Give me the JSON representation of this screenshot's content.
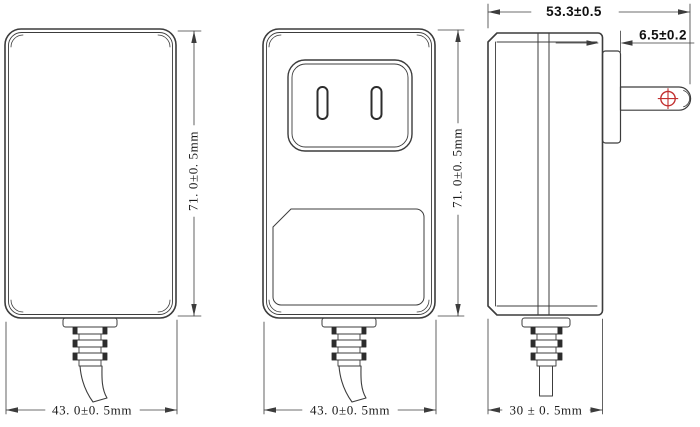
{
  "drawing": {
    "background": "#ffffff",
    "line_color": "#3c3c3c",
    "accent_red": "#c23030",
    "views": {
      "front": {
        "height_dim": "71. 0±0. 5mm",
        "width_dim": "43. 0±0. 5mm"
      },
      "back": {
        "height_dim": "71. 0±0. 5mm",
        "width_dim": "43. 0±0. 5mm"
      },
      "side": {
        "overall_width_dim": "53.3±0.5",
        "blade_face_dim": "6.5±0.2",
        "depth_dim": "30 ± 0. 5mm"
      }
    }
  }
}
